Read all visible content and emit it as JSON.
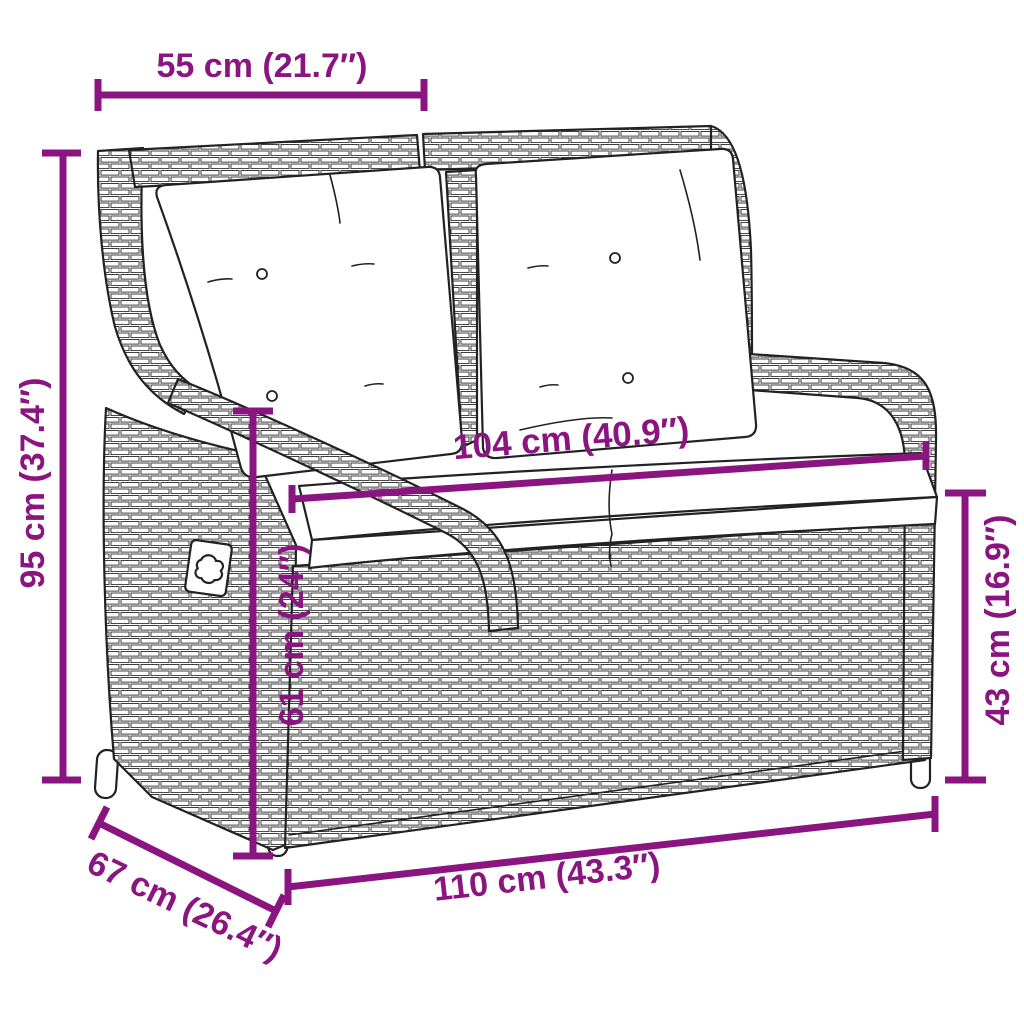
{
  "diagram": {
    "type": "product-dimension-diagram",
    "subject": "poly rattan reclining garden bench with cushions",
    "colors": {
      "dimension_color": "#8B1580",
      "line_art_color": "#222222",
      "background": "#ffffff",
      "cushion_color": "#ffffff"
    },
    "dimensions": {
      "top": {
        "label": "55 cm (21.7″)",
        "cm": 55,
        "inches": 21.7
      },
      "left": {
        "label": "95 cm (37.4″)",
        "cm": 95,
        "inches": 37.4
      },
      "seat": {
        "label": "104 cm (40.9″)",
        "cm": 104,
        "inches": 40.9
      },
      "inner": {
        "label": "61 cm (24″)",
        "cm": 61,
        "inches": 24
      },
      "right": {
        "label": "43 cm (16.9″)",
        "cm": 43,
        "inches": 16.9
      },
      "bottom": {
        "label": "110 cm (43.3″)",
        "cm": 110,
        "inches": 43.3
      },
      "depth": {
        "label": "67 cm (26.4″)",
        "cm": 67,
        "inches": 26.4
      }
    }
  }
}
